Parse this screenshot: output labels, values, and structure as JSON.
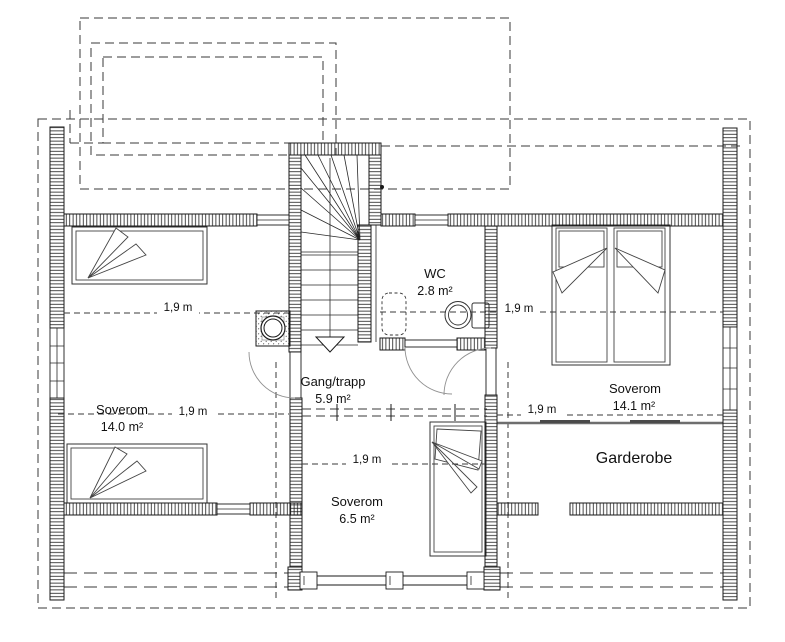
{
  "rooms": [
    {
      "name": "Soverom",
      "area": "14.0 m²"
    },
    {
      "name": "Gang/trapp",
      "area": "5.9 m²"
    },
    {
      "name": "Soverom",
      "area": "6.5 m²"
    },
    {
      "name": "WC",
      "area": "2.8 m²"
    },
    {
      "name": "Soverom",
      "area": "14.1 m²"
    },
    {
      "name": "Garderobe",
      "area": ""
    }
  ],
  "dim_labels": [
    "1,9 m",
    "1,9 m",
    "1,9 m",
    "1,9 m",
    "1,9 m"
  ],
  "colors": {
    "line": "#1a1a1a",
    "dashed_line": "#3a3a3a",
    "door_arc": "#909090",
    "garderobe_rail": "#6e6e6e",
    "background": "#ffffff"
  }
}
